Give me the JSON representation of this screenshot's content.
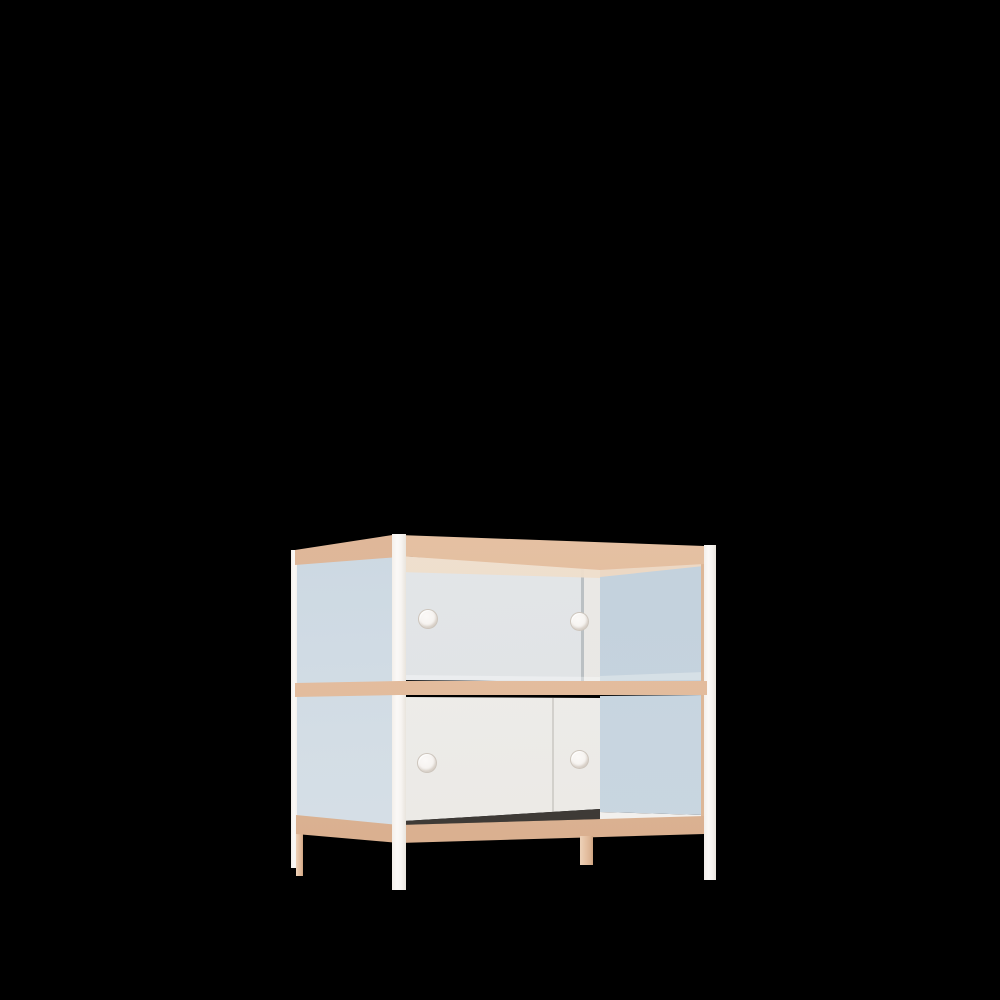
{
  "scene": {
    "type": "3d-product-render",
    "description": "Two-tier sideboard cabinet rendered on a black background: slender white metal frame posts, light wooden top shelf, middle shelf and bottom rail, blue-tinted glass side panels, a frosted glass sliding door on the upper tier and a white sliding door on the lower tier, each door with two round finger holes; wooden back legs.",
    "background_color": "#000000"
  },
  "furniture": {
    "name": "two-tier sliding-door glass sideboard",
    "tiers": 2,
    "finger_holes_per_tier": 2,
    "palette": {
      "frame_white": "#F8F5F2",
      "frame_white_shade": "#E9E4DD",
      "wood_light": "#EFD3B6",
      "wood_mid": "#E4BFA1",
      "wood_dark": "#D5AA89",
      "side_glass_blue": "#C5D3DF",
      "side_glass_blue_light": "#DAE2E8",
      "right_glass_blue": "#C0CFDB",
      "upper_door_frost": "#E4E7E9",
      "lower_door_white": "#EFEEEB",
      "interior_ceiling_beige": "#EFDECB",
      "interior_floor_white": "#F2F0ED",
      "door_gap_shadow": "#3E3A36",
      "finger_hole_fill": "#F6F3F0",
      "background": "#000000"
    },
    "parts": [
      {
        "name": "back-left-post",
        "material": "white-metal"
      },
      {
        "name": "back-left-leg",
        "material": "wood"
      },
      {
        "name": "left-side-glass-panel",
        "material": "tinted-glass"
      },
      {
        "name": "upper-sliding-door",
        "material": "frosted-glass",
        "finger_holes": 2
      },
      {
        "name": "upper-door-stile",
        "material": "frosted-glass"
      },
      {
        "name": "interior-ceiling",
        "material": "wood"
      },
      {
        "name": "upper-right-side-glass",
        "material": "tinted-glass"
      },
      {
        "name": "lower-sliding-door",
        "material": "white-panel",
        "finger_holes": 2
      },
      {
        "name": "lower-right-side-glass",
        "material": "tinted-glass"
      },
      {
        "name": "interior-floor",
        "material": "white-panel"
      },
      {
        "name": "top-shelf",
        "material": "wood"
      },
      {
        "name": "middle-shelf",
        "material": "wood"
      },
      {
        "name": "bottom-rail",
        "material": "wood"
      },
      {
        "name": "back-middle-leg",
        "material": "wood"
      },
      {
        "name": "front-left-post",
        "material": "white-metal"
      },
      {
        "name": "front-right-post",
        "material": "white-metal"
      }
    ]
  }
}
